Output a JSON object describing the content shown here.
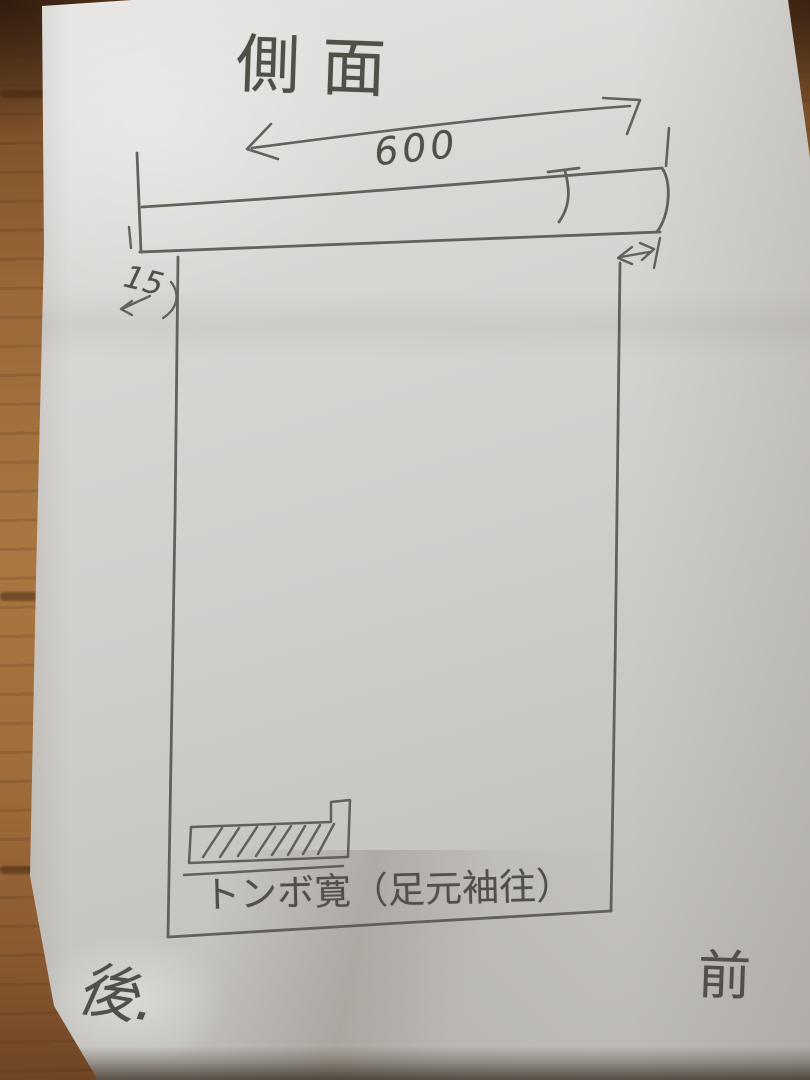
{
  "sketch": {
    "title": "側面",
    "top_width_label": "600",
    "left_offset_label": "15",
    "hatch_note": "トンボ寛（足元袖往）",
    "rear_label": "後.",
    "front_label": "前"
  },
  "symbols": {
    "top_dimension_arrow": "double-headed-arrow",
    "right_gap_symbol": "small-double-arrow-with-end-tick",
    "left_offset_symbol": "left-arrow",
    "hatch_pattern": "diagonal-hatching"
  },
  "colors": {
    "pencil": "#5b5853",
    "paper_light": "#e6e5e3",
    "paper_dark": "#bab7b2",
    "wood_mid": "#9c6a3a",
    "wood_dark": "#5c3a1f"
  }
}
